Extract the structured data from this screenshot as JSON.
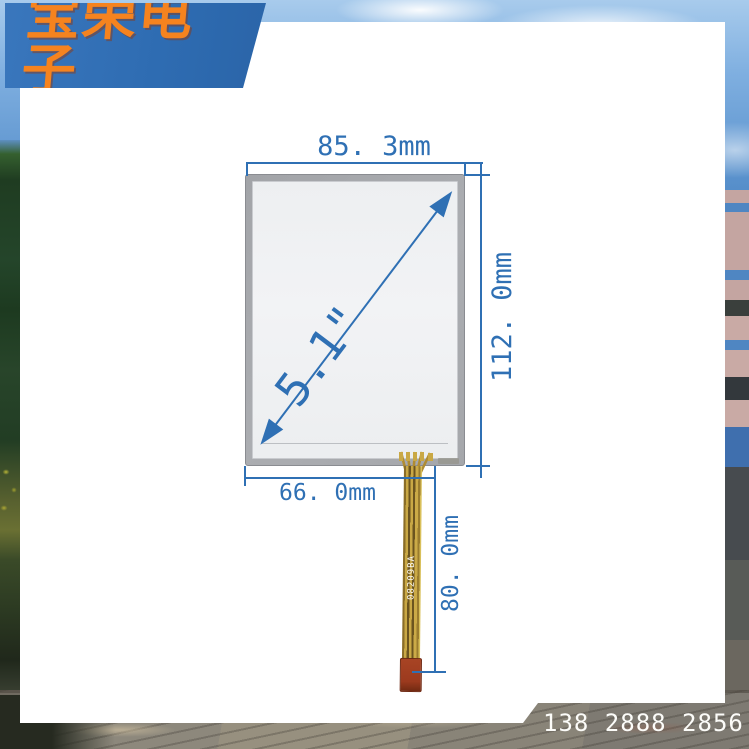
{
  "brand": {
    "logo_text": "宝荣电子"
  },
  "contact": {
    "phone_number": "138 2888 2856"
  },
  "panel": {
    "diagonal_size": "5.1\"",
    "top_width_label": "85. 3mm",
    "side_height_label": "112. 0mm",
    "bottom_width_label": "66. 0mm",
    "cable_length_label": "80. 0mm",
    "cable_marking": "08209BA"
  },
  "colors": {
    "annotation_blue": "#2f70b4",
    "banner_blue": "#2e6cb2",
    "logo_orange": "#f5831f",
    "panel_frame_gray": "#a8abaf",
    "glass_white": "#f0f2f3",
    "cable_gold": "#c9a845",
    "connector_red": "#9c3a1e"
  }
}
